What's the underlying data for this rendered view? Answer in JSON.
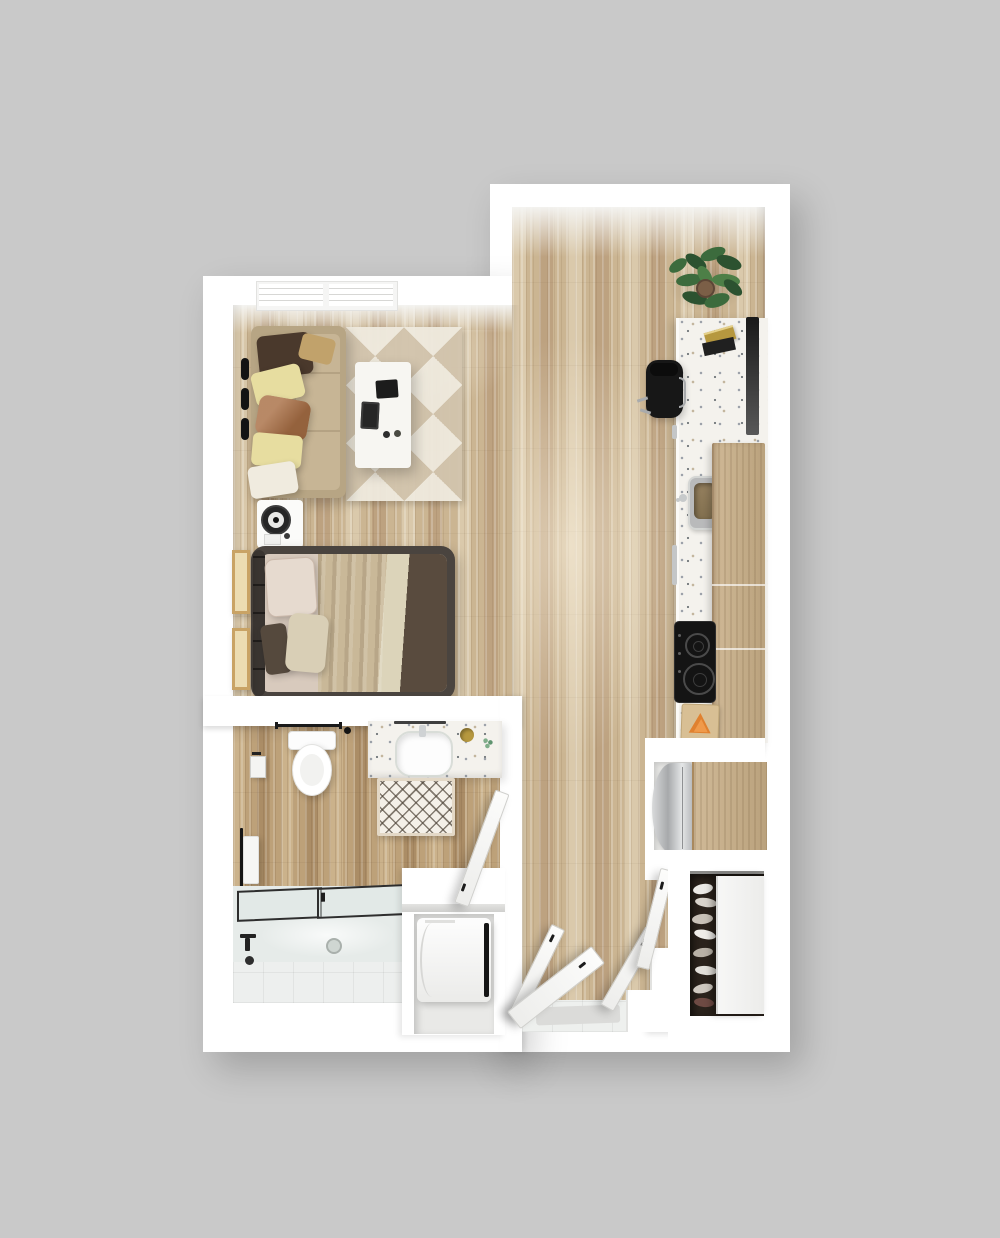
{
  "scene": {
    "description": "Top-down 3D rendered floor plan of a studio apartment with living area, bed, bathroom, kitchen run, entry and closets",
    "view": "top-down-render",
    "rooms": [
      "living-area",
      "sleeping-area",
      "bathroom",
      "kitchen",
      "entry-hall",
      "shoe-closet",
      "laundry-nook"
    ]
  },
  "inventory": [
    "sofa",
    "throw-pillows",
    "geometric-area-rug",
    "coffee-table",
    "laptop",
    "tablet",
    "mugs",
    "window-band",
    "blind-controls",
    "nightstand",
    "round-speaker",
    "double-bed",
    "bed-pillows",
    "layered-blanket",
    "wall-art-frames",
    "toilet",
    "toilet-paper-holder",
    "towel-bar",
    "vanity-counter",
    "oval-sink",
    "soap-dish",
    "bath-mat",
    "hand-towel",
    "bathtub",
    "glass-shower-screen",
    "tub-faucet",
    "washer-dryer",
    "bathroom-door",
    "kitchen-counter",
    "office-chair",
    "wall-mounted-tv",
    "books",
    "kitchen-sink",
    "cabinet-handles",
    "upper-cabinets",
    "induction-cooktop",
    "cutting-board",
    "orange-slices",
    "refrigerator",
    "potted-plant",
    "entry-doors",
    "entry-tile",
    "entry-mat",
    "threshold-steps",
    "sliding-closet-door",
    "shoe-rack",
    "shoes"
  ],
  "palette": {
    "bg": "#c9c9c9",
    "wall": "#ffffff",
    "floor-light": "#dac9ab",
    "floor-mid": "#cbb592",
    "floor-dark": "#bda280",
    "bath-light": "#cbb28b",
    "bath-mid": "#bda179",
    "bath-dark": "#ab8d66",
    "rug-a": "#d2c4ad",
    "rug-b": "#efeade",
    "sofa-frame": "#b7a584",
    "sofa-cushion": "#c7b595",
    "pillow-brown": "#4a392c",
    "pillow-gold": "#c1a26b",
    "pillow-yellow": "#e7dda0",
    "pillow-rust": "#a96f45",
    "pillow-cream": "#f0ebdf",
    "table-white": "#f7f6f2",
    "bed-frame": "#4a443f",
    "bed-sheet": "#d8cabd",
    "blanket-tan": "#c9b898",
    "blanket-cream": "#dcd4ba",
    "blanket-dark": "#594b3e",
    "counter": "#f4f2ed",
    "cabinet": "#c8ae86",
    "cooktop": "#141414",
    "tv-dark": "#191919",
    "chair-black": "#171717",
    "chrome": "#a8aaac",
    "steel": "#b9babb",
    "plant-dark": "#2c5230",
    "plant-mid": "#3c6b3d",
    "plant-light": "#4d7f47",
    "pot-brown": "#7b5f47",
    "tub-glass": "#dfe6e4",
    "tub-basin": "#e6ebe9",
    "tile": "#eef0ee",
    "door-white": "#fafafa",
    "closet-dark": "#2b231c",
    "gold": "#b6983f",
    "orange": "#e0812f",
    "mat": "#f4f0e8",
    "towel": "#f6f6f4"
  }
}
